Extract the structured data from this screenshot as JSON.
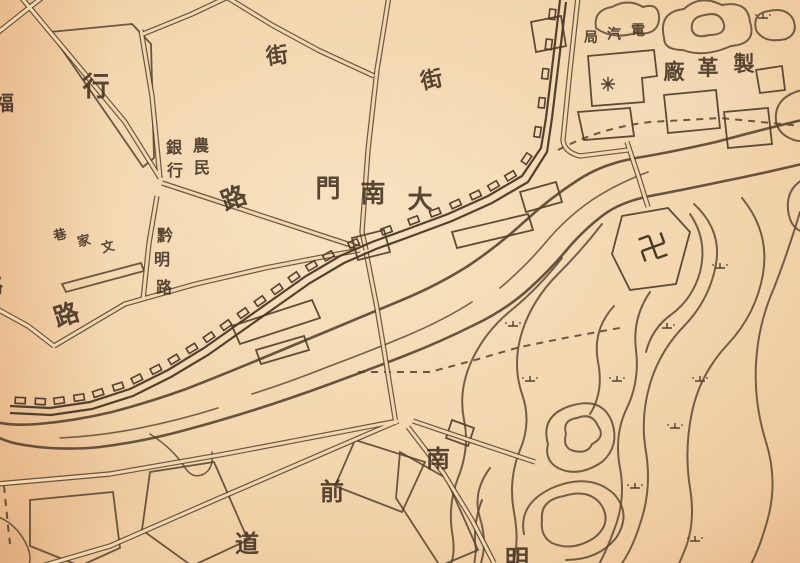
{
  "map": {
    "type": "historical-hand-drawn-city-map",
    "language": "chinese",
    "paper_color": "#f2d6ae",
    "ink_color": "#54412d",
    "compound_readings": {
      "gate": "大南門",
      "bank": "農民銀行",
      "road": "黔明路",
      "lane": "文家巷",
      "factory": "製革廠",
      "utility": "電汽局"
    },
    "labels": [
      {
        "text": "福",
        "x": 4,
        "y": 110,
        "size": 20,
        "rot": 0
      },
      {
        "text": "行",
        "x": 96,
        "y": 96,
        "size": 27,
        "rot": 0
      },
      {
        "text": "街",
        "x": 278,
        "y": 63,
        "size": 22,
        "rot": -8
      },
      {
        "text": "街",
        "x": 433,
        "y": 87,
        "size": 22,
        "rot": -12
      },
      {
        "text": "農",
        "x": 201,
        "y": 151,
        "size": 16,
        "rot": 0
      },
      {
        "text": "民",
        "x": 202,
        "y": 173,
        "size": 16,
        "rot": 0
      },
      {
        "text": "銀",
        "x": 174,
        "y": 153,
        "size": 16,
        "rot": 0
      },
      {
        "text": "行",
        "x": 175,
        "y": 176,
        "size": 16,
        "rot": 0
      },
      {
        "text": "路",
        "x": 237,
        "y": 206,
        "size": 25,
        "rot": -22
      },
      {
        "text": "黔",
        "x": 165,
        "y": 241,
        "size": 16,
        "rot": 0
      },
      {
        "text": "明",
        "x": 162,
        "y": 265,
        "size": 16,
        "rot": 0
      },
      {
        "text": "路",
        "x": 164,
        "y": 293,
        "size": 16,
        "rot": 0
      },
      {
        "text": "巷",
        "x": 61,
        "y": 239,
        "size": 13,
        "rot": -14
      },
      {
        "text": "家",
        "x": 85,
        "y": 245,
        "size": 13,
        "rot": -14
      },
      {
        "text": "文",
        "x": 109,
        "y": 251,
        "size": 13,
        "rot": -14
      },
      {
        "text": "門",
        "x": 328,
        "y": 197,
        "size": 25,
        "rot": 0
      },
      {
        "text": "南",
        "x": 373,
        "y": 202,
        "size": 25,
        "rot": 0
      },
      {
        "text": "大",
        "x": 420,
        "y": 208,
        "size": 25,
        "rot": 0
      },
      {
        "text": "路",
        "x": -7,
        "y": 292,
        "size": 20,
        "rot": 0
      },
      {
        "text": "路",
        "x": 69,
        "y": 323,
        "size": 25,
        "rot": -18
      },
      {
        "text": "局",
        "x": 591,
        "y": 42,
        "size": 14,
        "rot": 0
      },
      {
        "text": "汽",
        "x": 614,
        "y": 39,
        "size": 14,
        "rot": 0
      },
      {
        "text": "電",
        "x": 638,
        "y": 35,
        "size": 14,
        "rot": 0
      },
      {
        "text": "廠",
        "x": 674,
        "y": 79,
        "size": 21,
        "rot": 0
      },
      {
        "text": "革",
        "x": 708,
        "y": 75,
        "size": 21,
        "rot": 0
      },
      {
        "text": "製",
        "x": 744,
        "y": 71,
        "size": 21,
        "rot": 0
      },
      {
        "text": "南",
        "x": 438,
        "y": 467,
        "size": 24,
        "rot": 0
      },
      {
        "text": "前",
        "x": 332,
        "y": 500,
        "size": 24,
        "rot": 0
      },
      {
        "text": "道",
        "x": 247,
        "y": 552,
        "size": 24,
        "rot": 0
      },
      {
        "text": "明",
        "x": 517,
        "y": 567,
        "size": 24,
        "rot": 0
      }
    ],
    "symbols": {
      "swastika_temple": {
        "glyph": "卍",
        "x": 653,
        "y": 247,
        "rot": -20
      },
      "star": {
        "x": 608,
        "y": 84
      },
      "terrain_marks": [
        [
          763,
          17
        ],
        [
          720,
          267
        ],
        [
          667,
          327
        ],
        [
          513,
          325
        ],
        [
          530,
          380
        ],
        [
          617,
          380
        ],
        [
          700,
          380
        ],
        [
          675,
          427
        ],
        [
          635,
          487
        ],
        [
          695,
          540
        ]
      ]
    }
  }
}
